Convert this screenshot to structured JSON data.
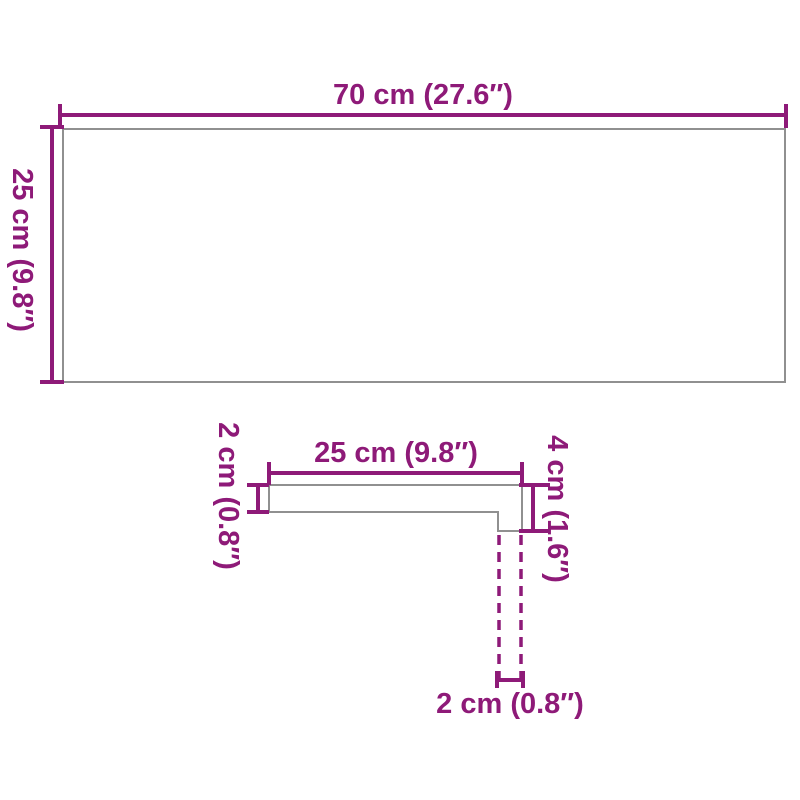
{
  "title": "Product dimension diagram",
  "colors": {
    "dimension_line": "#8E1A78",
    "product_outline": "#909090",
    "background": "#FFFFFF"
  },
  "front_view": {
    "width_label": "70 cm (27.6″)",
    "height_label": "25 cm (9.8″)"
  },
  "profile_view": {
    "depth_label": "25 cm (9.8″)",
    "thickness_label": "2 cm (0.8″)",
    "nose_height_label": "4 cm (1.6″)",
    "nose_depth_label": "2 cm (0.8″)"
  }
}
